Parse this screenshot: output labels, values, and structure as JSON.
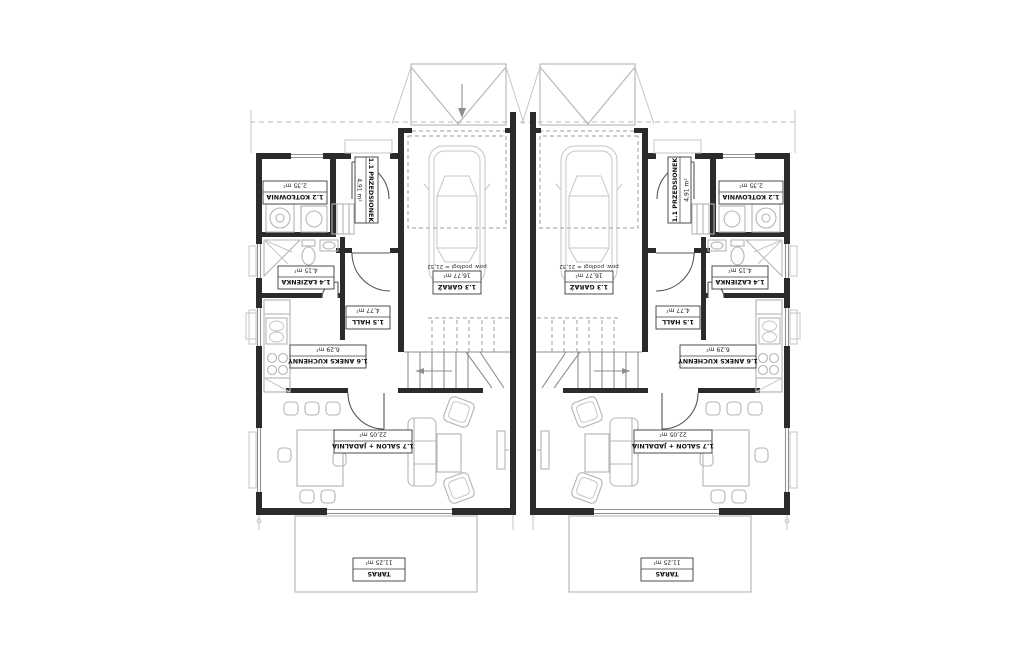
{
  "plan": {
    "type": "floor-plan",
    "orientation_note": "plan rendered rotated 180° (labels upside-down)",
    "units": [
      "left-unit",
      "right-unit"
    ],
    "rooms": [
      {
        "id": "1.1",
        "name": "1.1 PRZEDSIONEK",
        "area": "4,91 m²"
      },
      {
        "id": "1.2",
        "name": "1.2 KOTŁOWNIA",
        "area": "2,35 m²"
      },
      {
        "id": "1.3",
        "name": "1.3 GARAŻ",
        "area": "16,77 m²",
        "note": "pow. podłogi = 21,32"
      },
      {
        "id": "1.4",
        "name": "1.4 ŁAZIENKA",
        "area": "4,15 m²"
      },
      {
        "id": "1.5",
        "name": "1.5 HALL",
        "area": "4,77 m²"
      },
      {
        "id": "1.6",
        "name": "1.6 ANEKS KUCHENNY",
        "area": "6,29 m²"
      },
      {
        "id": "1.7",
        "name": "1.7 SALON + JADALNIA",
        "area": "22,05 m²"
      },
      {
        "id": "taras",
        "name": "TARAS",
        "area": "11,25 m²"
      }
    ],
    "colors": {
      "wall": "#2b2b2b",
      "furniture": "#b5b5b5",
      "dashed": "#9d9d9d",
      "background": "#ffffff"
    }
  }
}
